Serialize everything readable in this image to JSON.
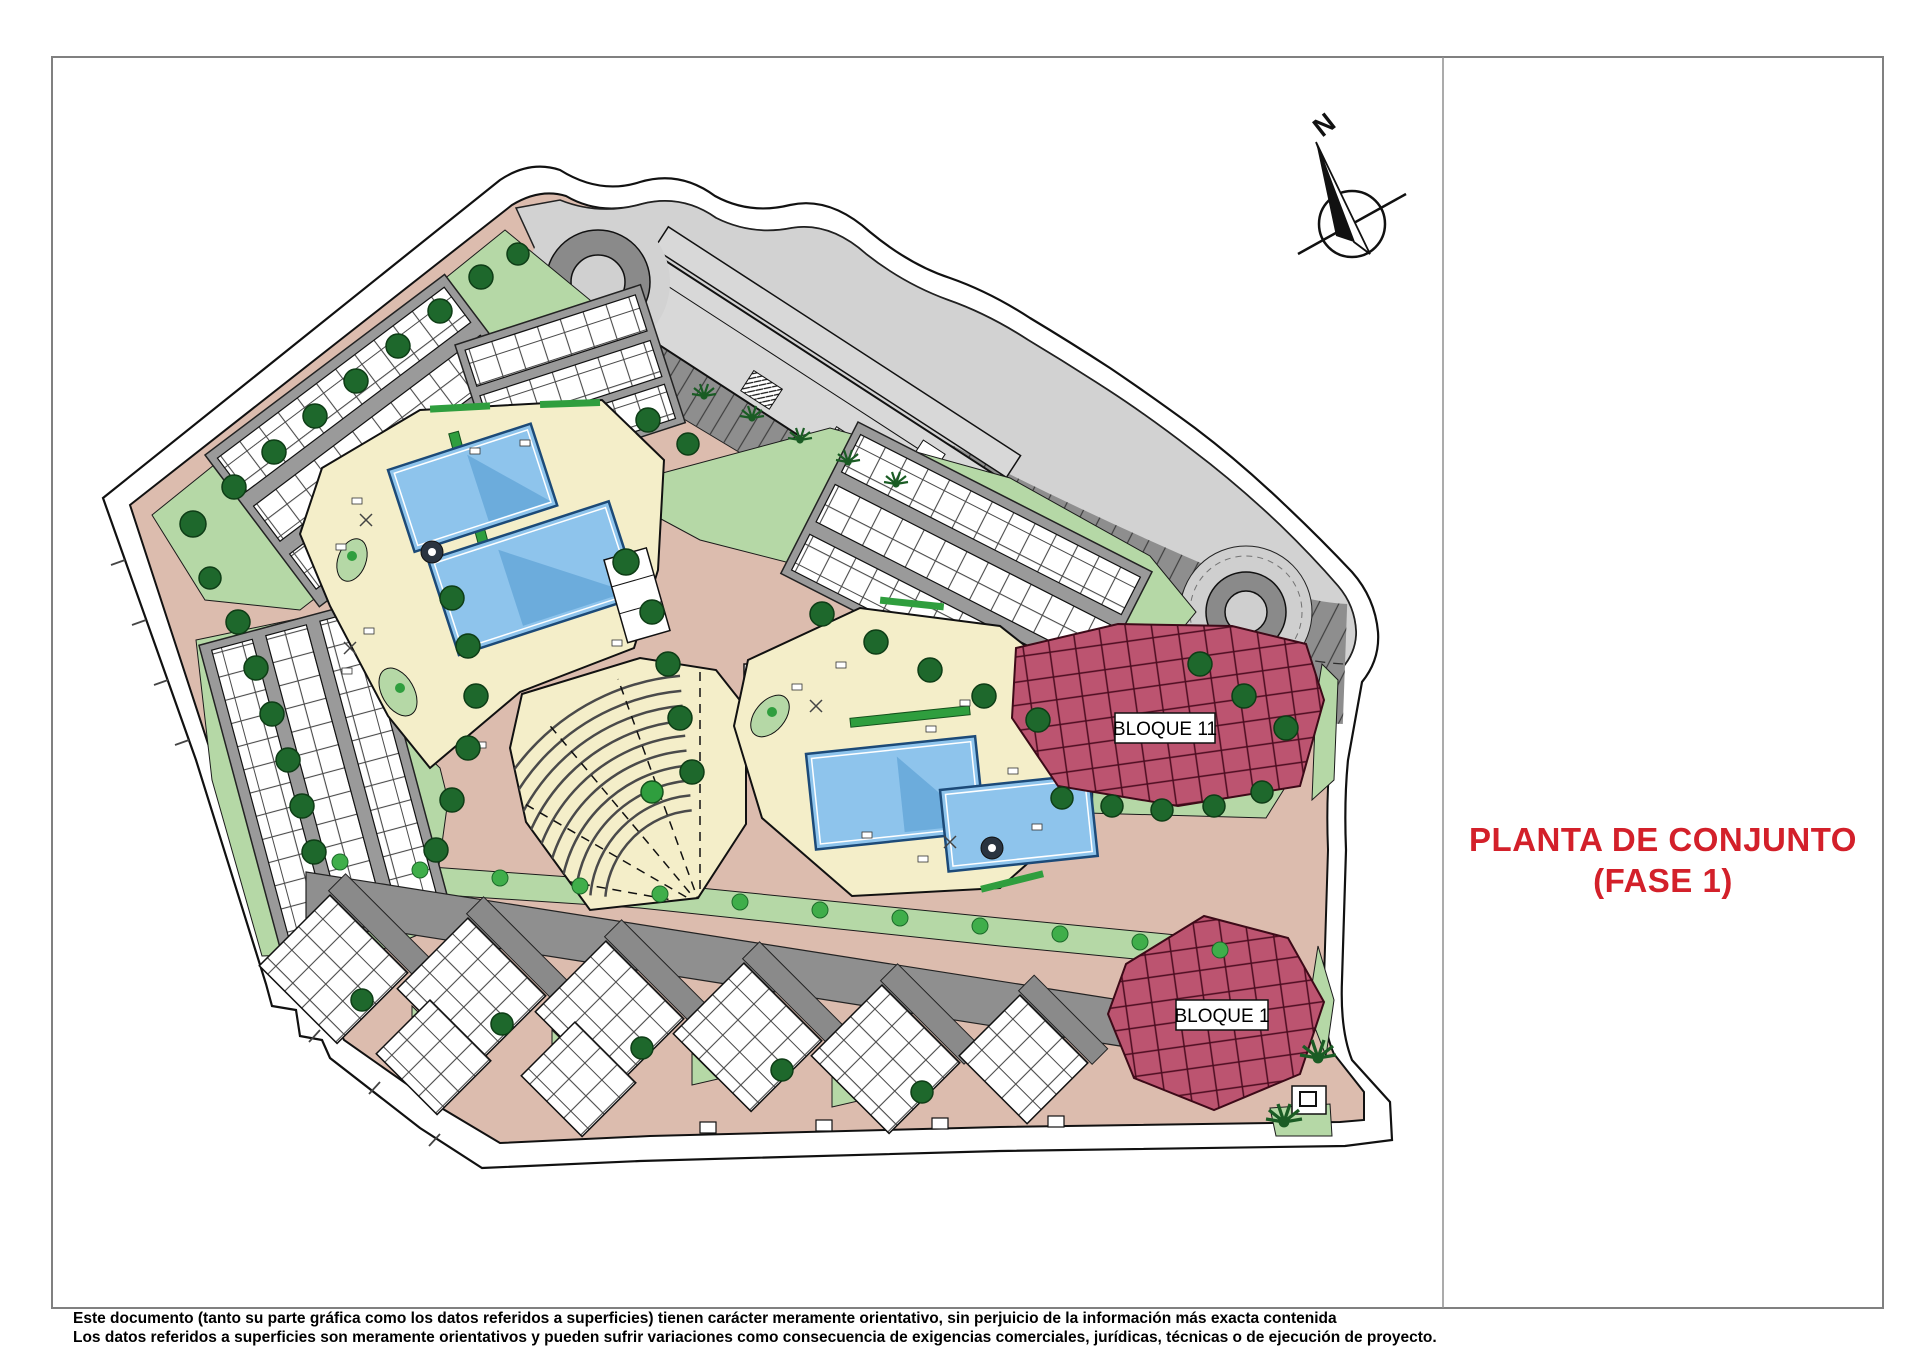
{
  "sheet": {
    "background": "#ffffff"
  },
  "title": {
    "line1": "PLANTA DE CONJUNTO",
    "line2": "(FASE 1)",
    "color": "#d3202a"
  },
  "compass": {
    "label": "N"
  },
  "plan": {
    "type": "architectural-site-plan",
    "blocks": [
      {
        "label": "BLOQUE 11"
      },
      {
        "label": "BLOQUE 1"
      }
    ],
    "colors": {
      "path": "#dcbcae",
      "green": "#b5d8a6",
      "deck": "#f4eec9",
      "pool": "#8ec4ec",
      "parking_dark": "#8e8e8e",
      "parking_light": "#d2d2d2",
      "block_highlight": "#bc5470",
      "tree": "#1e682c"
    }
  },
  "footer": {
    "line1": "Este documento (tanto su parte gráfica como los datos referidos a superficies) tienen carácter meramente orientativo, sin perjuicio de la información más exacta contenida",
    "line2": "Los datos referidos a superficies son meramente orientativos y pueden sufrir variaciones como consecuencia de exigencias comerciales, jurídicas, técnicas o de ejecución de proyecto."
  }
}
